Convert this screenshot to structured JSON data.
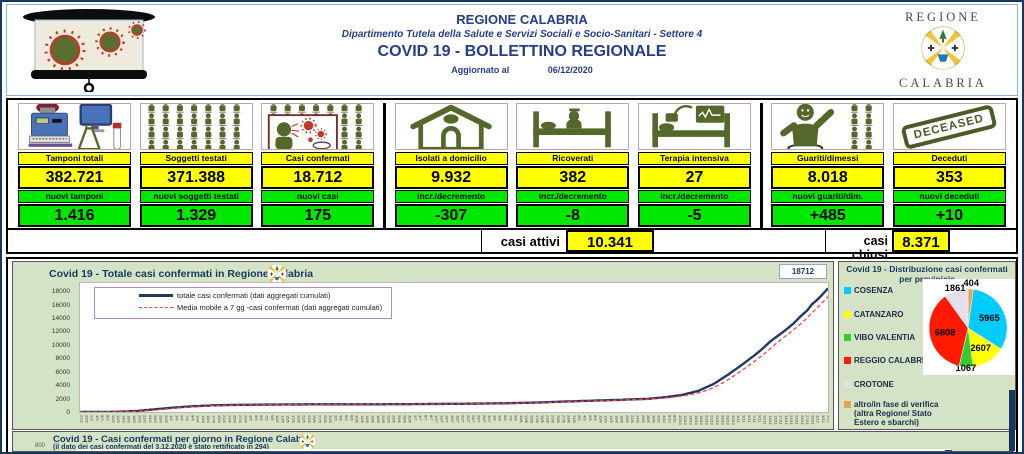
{
  "header": {
    "title": "REGIONE CALABRIA",
    "subtitle": "Dipartimento Tutela della Salute e Servizi Sociali e Socio-Sanitari - Settore 4",
    "bulletin_title": "COVID 19 - BOLLETTINO REGIONALE",
    "updated_label": "Aggiornato al",
    "updated_date": "06/12/2020",
    "logo_top": "REGIONE",
    "logo_bottom": "CALABRIA"
  },
  "palette": {
    "highlight_yellow": "#FFFF00",
    "highlight_green": "#00E800",
    "panel_green_bg": "#D4E3C5",
    "header_blue": "#253D8F",
    "line_navy": "#1F3864",
    "line_red": "#FF4040",
    "icon_olive": "#55682C"
  },
  "stats": {
    "cards": [
      {
        "icon": "lab-analyzer-icon",
        "label": "Tamponi totali",
        "value": "382.721",
        "sub_label": "nuovi tamponi",
        "sub_value": "1.416"
      },
      {
        "icon": "tested-people-grid-icon",
        "label": "Soggetti testati",
        "value": "371.388",
        "sub_label": "nuovi soggetti testati",
        "sub_value": "1.329"
      },
      {
        "icon": "confirmed-cases-icon",
        "label": "Casi confermati",
        "value": "18.712",
        "sub_label": "nuovi casi",
        "sub_value": "175"
      },
      {
        "icon": "home-isolation-icon",
        "label": "Isolati a domicilio",
        "value": "9.932",
        "sub_label": "incr./decremento",
        "sub_value": "-307"
      },
      {
        "icon": "hospital-bed-icon",
        "label": "Ricoverati",
        "value": "382",
        "sub_label": "incr./decremento",
        "sub_value": "-8"
      },
      {
        "icon": "intensive-care-icon",
        "label": "Terapia intensiva",
        "value": "27",
        "sub_label": "incr./decremento",
        "sub_value": "-5"
      },
      {
        "icon": "recovered-person-icon",
        "label": "Guariti/dimessi",
        "value": "8.018",
        "sub_label": "nuovi guariti/dim.",
        "sub_value": "+485"
      },
      {
        "icon": "deceased-stamp-icon",
        "label": "Deceduti",
        "value": "353",
        "sub_label": "nuovi deceduti",
        "sub_value": "+10",
        "stamp_text": "DECEASED"
      }
    ],
    "summary": {
      "active_label": "casi attivi",
      "active_value": "10.341",
      "closed_label": "casi chiusi",
      "closed_value": "8.371"
    }
  },
  "chart_data": [
    {
      "type": "line",
      "title": "Covid 19 - Totale casi confermati in Regione Calabria",
      "series": [
        {
          "name": "totale casi confermati (dati aggregati cumulati)",
          "color": "#1F3864",
          "style": "solid"
        },
        {
          "name": "Media mobile a 7 gg -casi confermati (dati aggregati cumulati)",
          "color": "#FF4040",
          "style": "dashed"
        }
      ],
      "points": [
        [
          0,
          1
        ],
        [
          8,
          2
        ],
        [
          15,
          40
        ],
        [
          22,
          170
        ],
        [
          29,
          430
        ],
        [
          36,
          680
        ],
        [
          43,
          870
        ],
        [
          50,
          1000
        ],
        [
          57,
          1060
        ],
        [
          63,
          1090
        ],
        [
          70,
          1120
        ],
        [
          80,
          1140
        ],
        [
          95,
          1160
        ],
        [
          110,
          1170
        ],
        [
          125,
          1190
        ],
        [
          140,
          1230
        ],
        [
          155,
          1290
        ],
        [
          165,
          1350
        ],
        [
          175,
          1450
        ],
        [
          185,
          1600
        ],
        [
          195,
          1720
        ],
        [
          205,
          1850
        ],
        [
          215,
          2000
        ],
        [
          222,
          2250
        ],
        [
          228,
          2600
        ],
        [
          234,
          3200
        ],
        [
          240,
          4300
        ],
        [
          245,
          5600
        ],
        [
          250,
          7000
        ],
        [
          255,
          8500
        ],
        [
          258,
          9500
        ],
        [
          261,
          10600
        ],
        [
          264,
          11500
        ],
        [
          267,
          12400
        ],
        [
          270,
          13400
        ],
        [
          273,
          14600
        ],
        [
          275,
          15300
        ],
        [
          277,
          16300
        ],
        [
          279,
          17000
        ],
        [
          281,
          17800
        ],
        [
          283,
          18712
        ]
      ],
      "x_start_date": "2020-02-27",
      "x_end_date": "2020-12-06",
      "x_tick_step_days": 2,
      "yticks": [
        0,
        2000,
        4000,
        6000,
        8000,
        10000,
        12000,
        14000,
        16000,
        18000
      ],
      "y_scale_max": 19500,
      "max_label": "18712",
      "legend_position": "top-left",
      "grid": false
    },
    {
      "type": "pie",
      "title": "Covid 19 - Distribuzione casi confermati per provinicia",
      "labels": [
        "COSENZA",
        "CATANZARO",
        "VIBO VALENTIA",
        "REGGIO CALABRIA",
        "CROTONE",
        "altro/in fase di verifica (altra Regione/ Stato Estero e sbarchi)"
      ],
      "values": [
        5965,
        2607,
        1067,
        6808,
        1861,
        404
      ],
      "colors": [
        "#00CCFF",
        "#FFFF00",
        "#33CC33",
        "#FF1A00",
        "#E4DFEC",
        "#EDA04F"
      ],
      "draw_order": [
        5,
        0,
        1,
        2,
        3,
        4
      ],
      "total": 18712
    },
    {
      "type": "line",
      "title": "Covid 19 - Casi confermati per giorno in Regione Calabria",
      "subtitle": "(il dato dei casi confermati del 3.12.2020 è stato rettificato in 294)",
      "visible_ytick": "800"
    }
  ]
}
